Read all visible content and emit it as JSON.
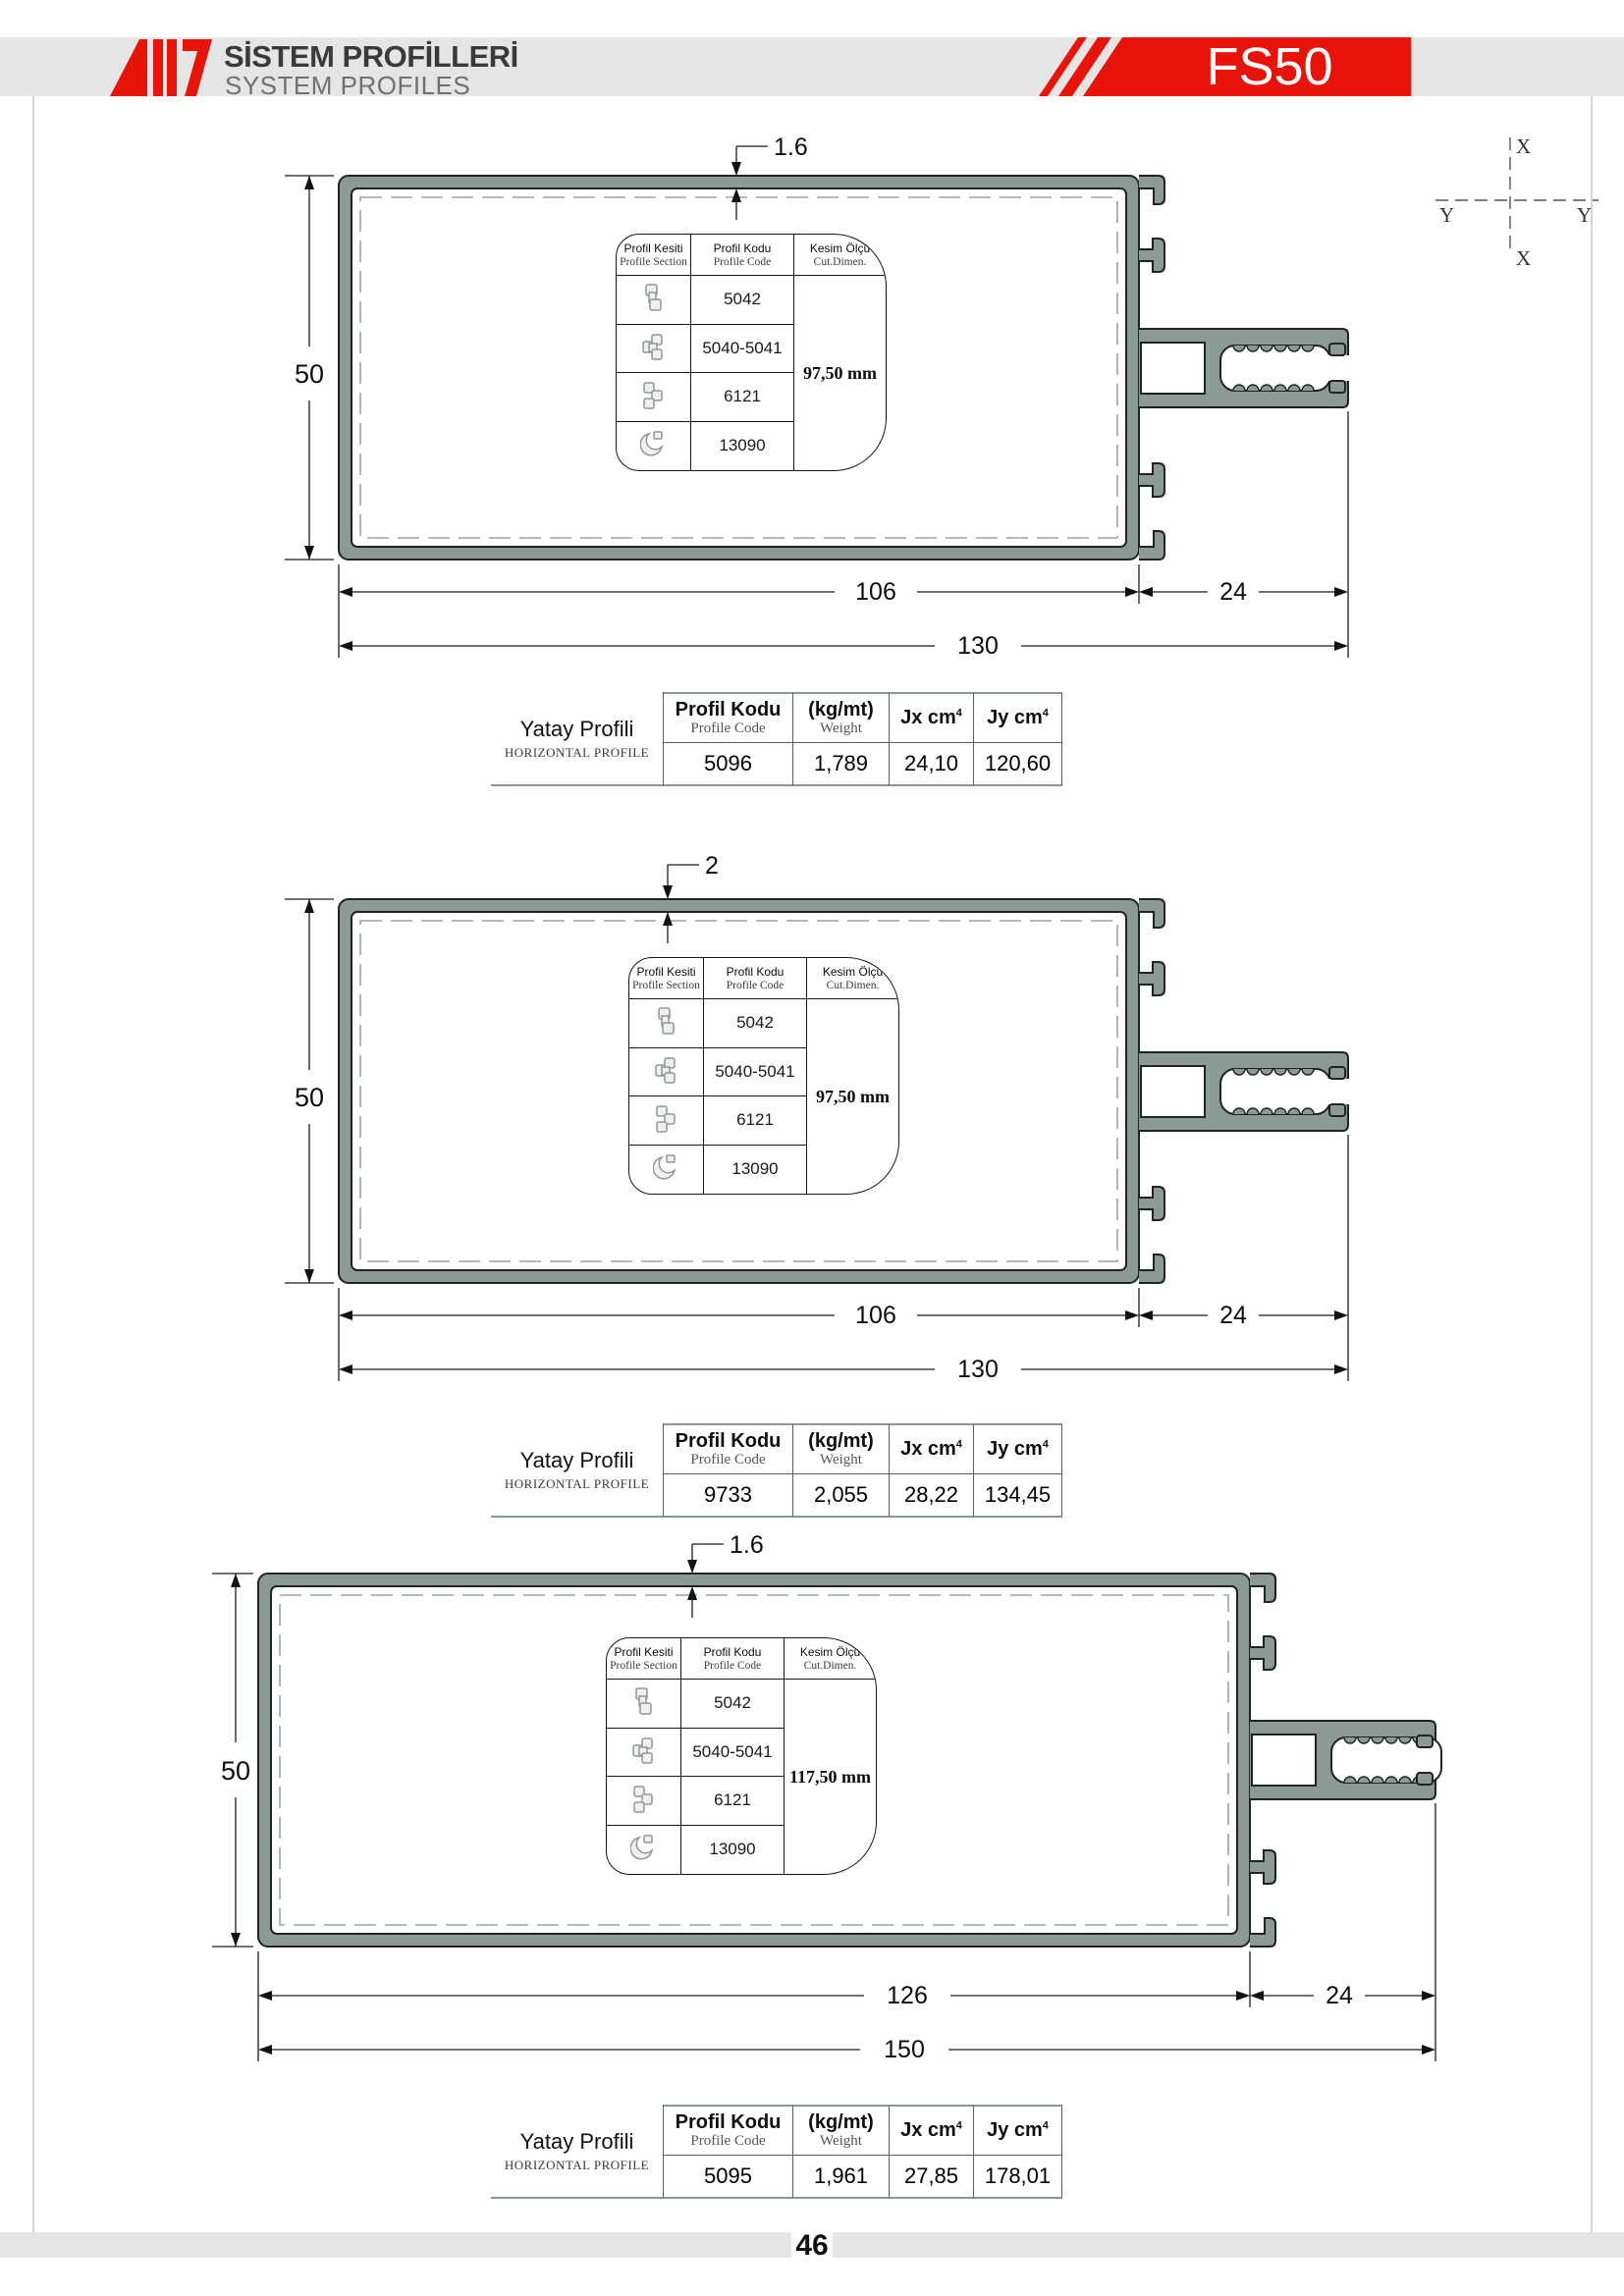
{
  "header": {
    "title_tr": "SİSTEM PROFİLLERİ",
    "title_en": "SYSTEM PROFILES",
    "product_code": "FS50",
    "accent_red": "#e81309",
    "band_gray": "#e4e6e5"
  },
  "axis": {
    "top": "X",
    "bottom": "X",
    "left": "Y",
    "right": "Y"
  },
  "card": {
    "col1_tr": "Profil Kesiti",
    "col1_en": "Profile Section",
    "col2_tr": "Profil Kodu",
    "col2_en": "Profile Code",
    "col3_tr": "Kesim Ölçü",
    "col3_en": "Cut.Dimen.",
    "codes": [
      "5042",
      "5040-5041",
      "6121",
      "13090"
    ]
  },
  "table_labels": {
    "row_tr": "Yatay Profili",
    "row_en": "HORIZONTAL PROFILE",
    "code_tr": "Profil Kodu",
    "code_en": "Profile Code",
    "weight_tr": "(kg/mt)",
    "weight_en": "Weight",
    "jx": "Jx cm",
    "jy": "Jy cm",
    "sup": "4"
  },
  "drawings": [
    {
      "height": "50",
      "width_inner": "106",
      "arm": "24",
      "width_outer": "130",
      "thickness": "1.6",
      "cut": "97,50 mm",
      "code": "5096",
      "weight": "1,789",
      "jx": "24,10",
      "jy": "120,60"
    },
    {
      "height": "50",
      "width_inner": "106",
      "arm": "24",
      "width_outer": "130",
      "thickness": "2",
      "cut": "97,50 mm",
      "code": "9733",
      "weight": "2,055",
      "jx": "28,22",
      "jy": "134,45"
    },
    {
      "height": "50",
      "width_inner": "126",
      "arm": "24",
      "width_outer": "150",
      "thickness": "1.6",
      "cut": "117,50 mm",
      "code": "5095",
      "weight": "1,961",
      "jx": "27,85",
      "jy": "178,01"
    }
  ],
  "footer": {
    "page": "46"
  },
  "profile_color": "#8b9a95"
}
